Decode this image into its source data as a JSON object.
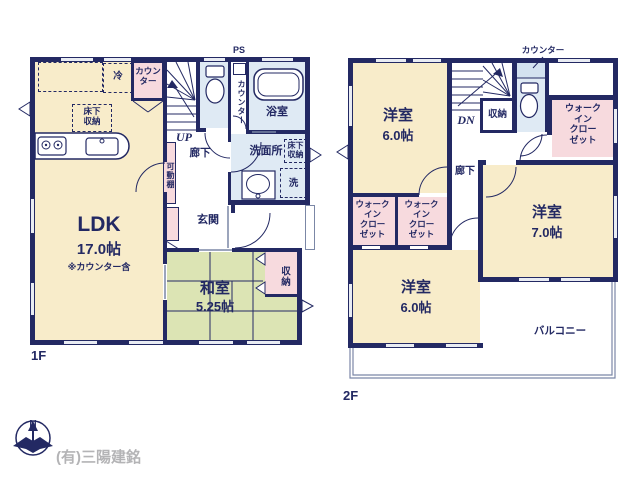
{
  "floor1": {
    "floor_label": "1F",
    "ldk": {
      "name": "LDK",
      "size": "17.0帖",
      "note": "※カウンター含"
    },
    "kitchen": {
      "fridge": "冷",
      "counter": "カウン\nター",
      "floor_storage": "床下\n収納"
    },
    "stairs_up": "UP",
    "hallway": "廊下",
    "ps": "PS",
    "ps_counter": "カウンター",
    "bathroom": "浴室",
    "washroom": "洗面所",
    "washroom_floor_storage": "床下\n収納",
    "laundry": "洗",
    "movable_shelf": "可動棚",
    "entrance": "玄関",
    "washitsu": {
      "name": "和室",
      "size": "5.25帖"
    },
    "closet": "収納"
  },
  "floor2": {
    "floor_label": "2F",
    "counter": "カウンター",
    "stairs_down": "DN",
    "closet": "収納",
    "hallway": "廊下",
    "bedroom_nw": {
      "name": "洋室",
      "size": "6.0帖"
    },
    "bedroom_se": {
      "name": "洋室",
      "size": "7.0帖"
    },
    "bedroom_sw": {
      "name": "洋室",
      "size": "6.0帖"
    },
    "wic_east": "ウォーク\nイン\nクロー\nゼット",
    "wic_sw1": "ウォーク\nイン\nクロー\nゼット",
    "wic_sw2": "ウォーク\nイン\nクロー\nゼット",
    "balcony": "バルコニー"
  },
  "footer": {
    "compass_n": "N",
    "company": "(有)三陽建銘"
  },
  "colors": {
    "wall": "#232963",
    "room_cream": "#f8ecca",
    "tatami_green": "#dce4b4",
    "closet_pink": "#f7dade",
    "wet_area_blue": "#dfeaf4",
    "company_gray": "#b4b4b6"
  }
}
